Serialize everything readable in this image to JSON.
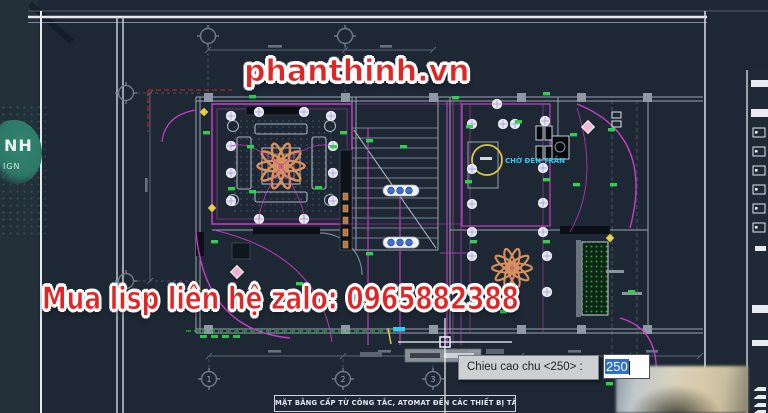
{
  "watermarks": {
    "website": "phanthinh.vn",
    "contact": "Mua lisp liên hệ zalo: 0965882388",
    "logo_top": "NH",
    "logo_bottom": "IGN"
  },
  "dynamic_input": {
    "prompt": "Chieu cao chu <250> :",
    "value": "250"
  },
  "drawing": {
    "title_block": "MẶT BẰNG CẤP TỪ CÔNG TẮC, ATOMAT ĐẾN CÁC THIẾT BỊ TẦNG 1",
    "labels": {
      "ceiling_wait": "CHỜ ĐÈN TRẦN"
    },
    "grid_bubbles": [
      "1",
      "2",
      "3"
    ]
  },
  "colors": {
    "background": "#1e2834",
    "wiring_magenta": "#c83cc8",
    "watermark_red": "#e32424",
    "selection_blue": "#2f6fd0",
    "label_green": "#2fd04a",
    "accent_yellow": "#e8d24a",
    "accent_cyan": "#35c8f0",
    "fan_orange": "#d8905c"
  }
}
